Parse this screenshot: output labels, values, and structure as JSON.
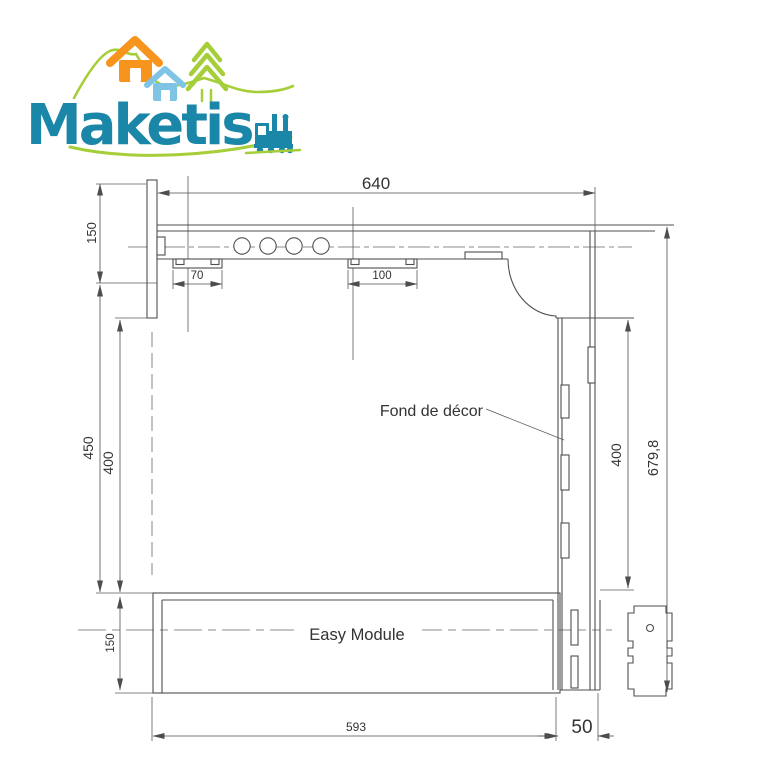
{
  "logo": {
    "brand": "Maketis",
    "icons": [
      "hills-line",
      "orange-house",
      "blue-house",
      "pine-tree",
      "steam-train"
    ],
    "colors": {
      "teal": "#1a86a8",
      "orange": "#f7941d",
      "light_blue": "#7fc4e4",
      "lime": "#a6ce39"
    }
  },
  "drawing": {
    "annotations": {
      "backdrop_label": "Fond de décor",
      "module_label": "Easy Module"
    },
    "dimensions": {
      "top_width": "640",
      "left_upper": "150",
      "left_outer": "450",
      "left_inner": "400",
      "tab_left": "70",
      "tab_right": "100",
      "right_inner": "400",
      "right_total": "679,8",
      "bottom_length": "593",
      "bottom_depth": "50",
      "left_lower": "150"
    },
    "colors": {
      "line": "#4f4f4f",
      "text": "#333333"
    }
  }
}
